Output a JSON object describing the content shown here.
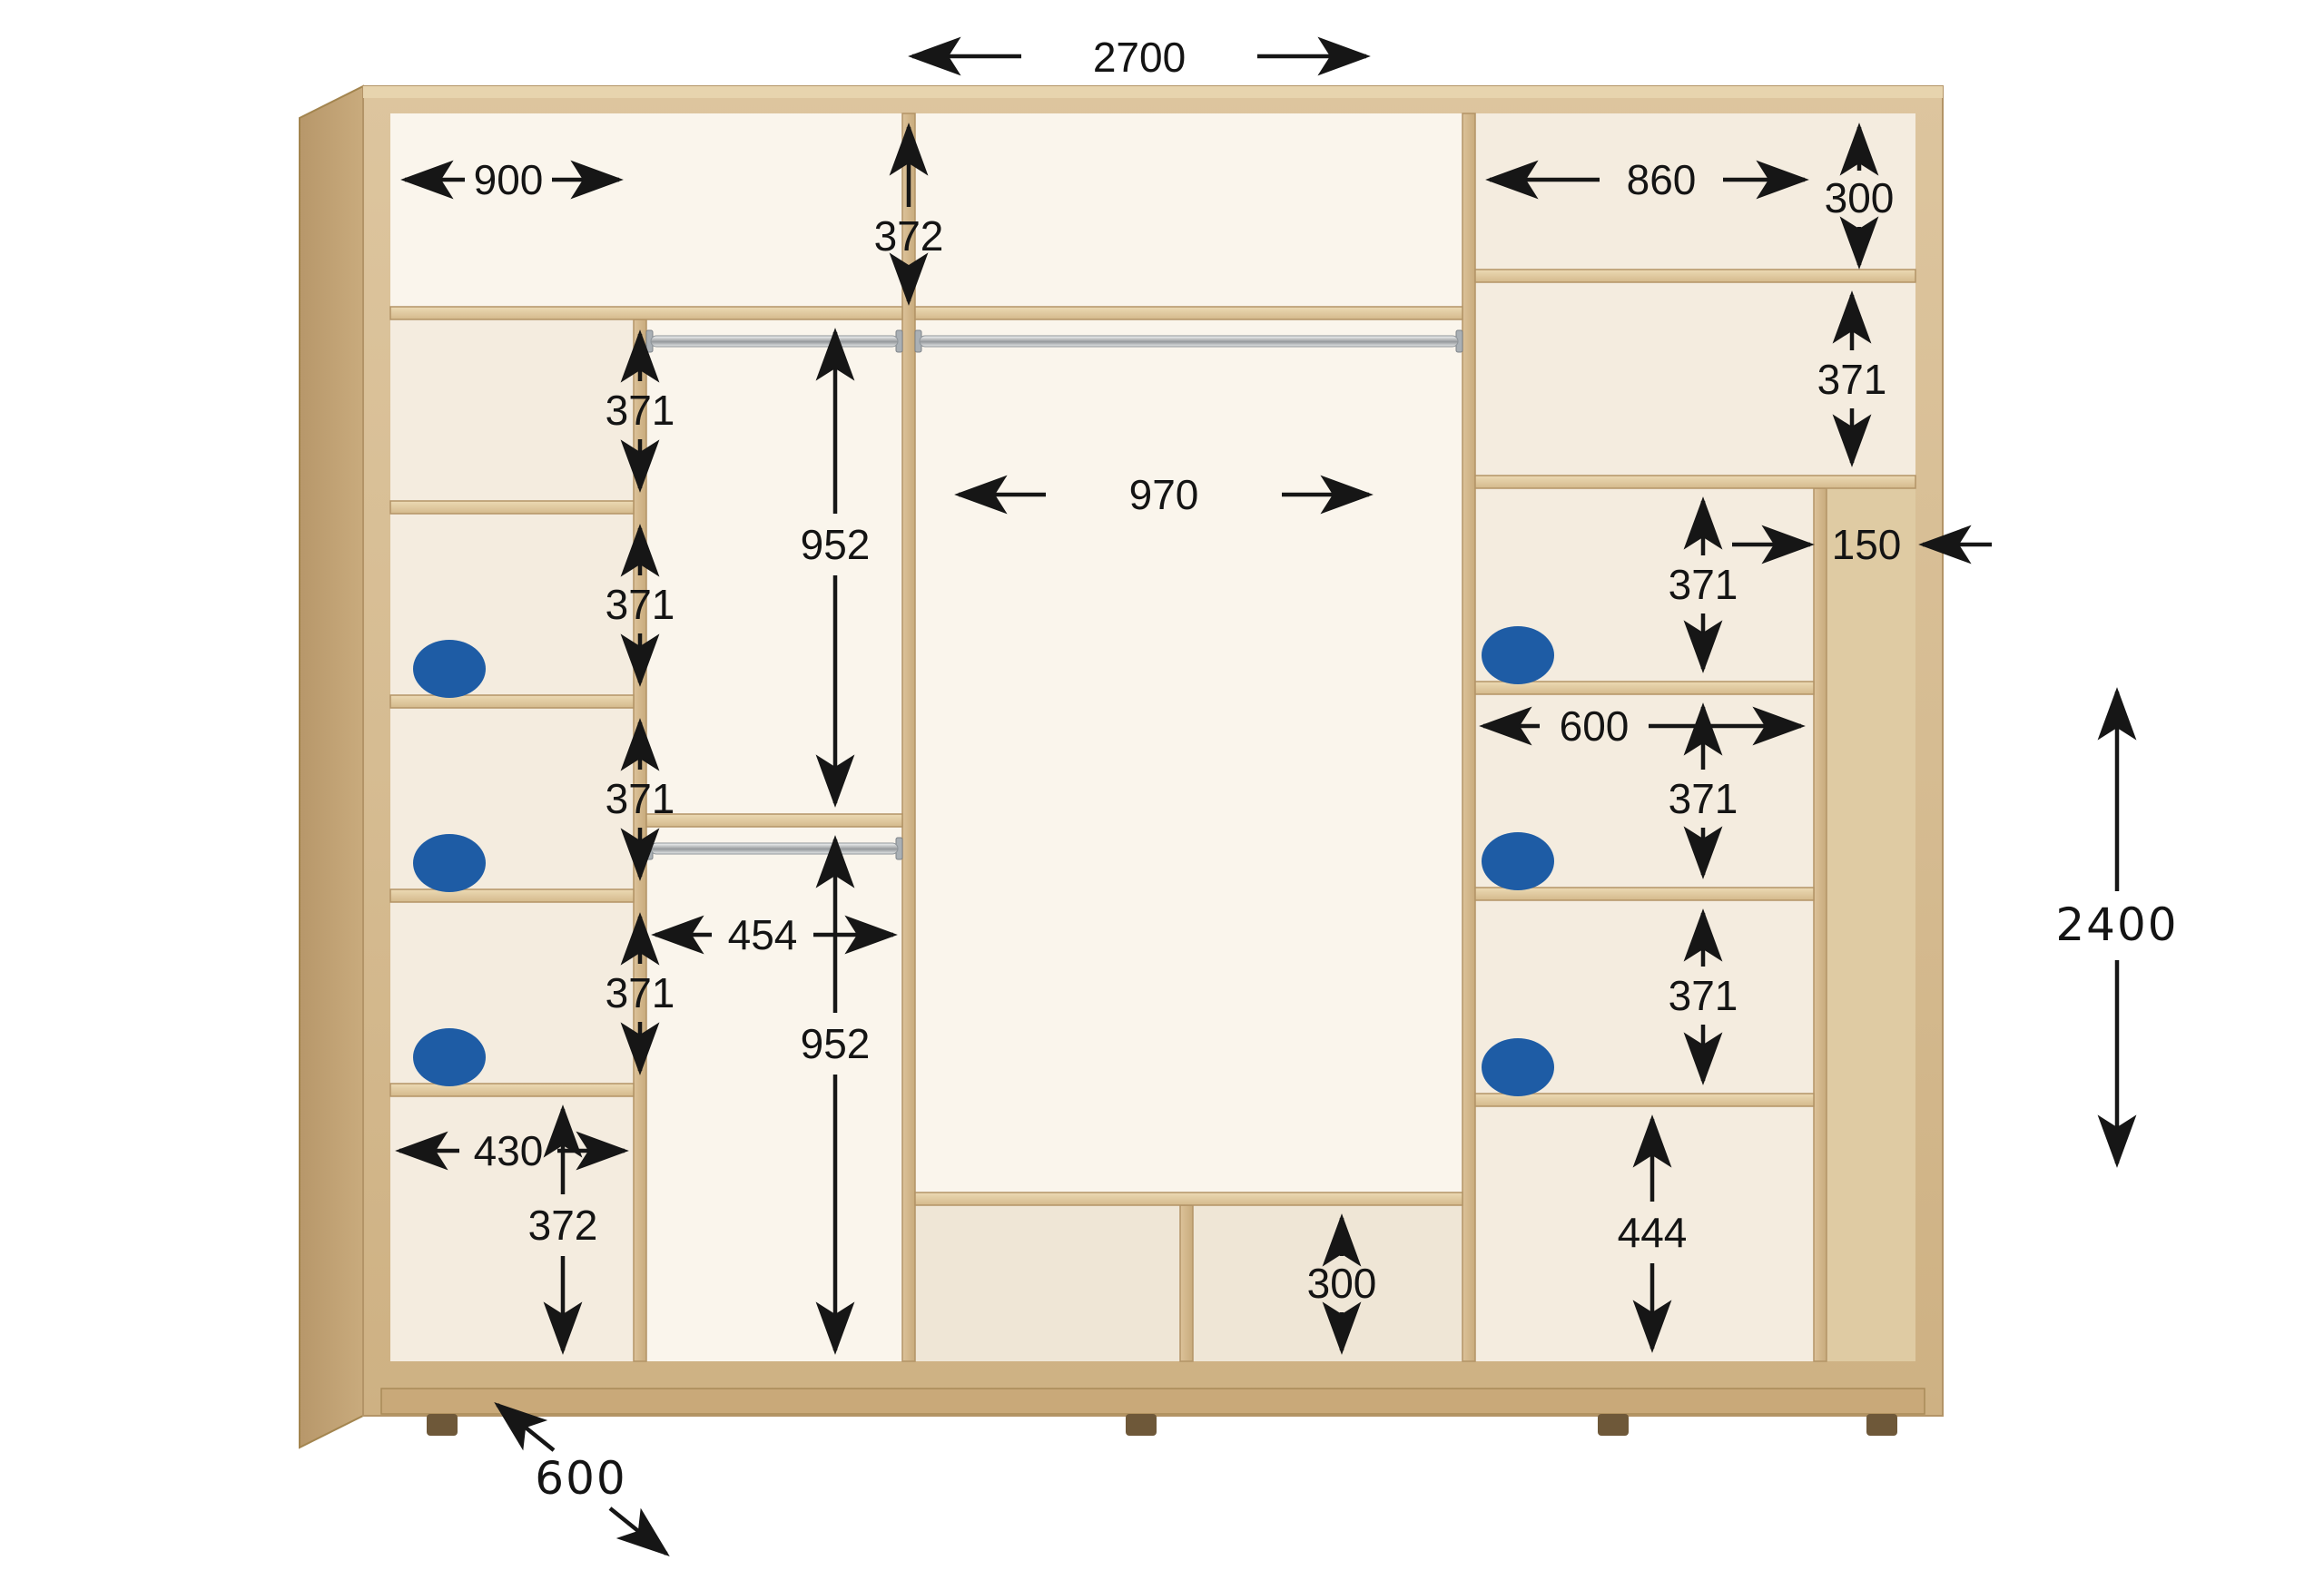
{
  "diagram": {
    "subject": "wardrobe-interior-dimension-diagram",
    "units": "mm",
    "background_color": "#ffffff",
    "wood_color": "#d8bf96",
    "marker_color": "#1e5ca5",
    "dimension_color": "#141414"
  },
  "overall": {
    "width": "2700",
    "height": "2400",
    "depth": "600"
  },
  "top": {
    "left_cell_width": "900",
    "left_cell_height": "372",
    "right_cell_width": "860",
    "right_cell_height": "300"
  },
  "left_col": {
    "cell1_height": "371",
    "cell2_height": "371",
    "cell3_height": "371",
    "cell4_height": "371",
    "bottom_cell_width": "430",
    "bottom_cell_height": "372"
  },
  "hang": {
    "upper_height": "952",
    "width": "454",
    "lower_height": "952"
  },
  "center": {
    "opening_width": "970",
    "bottom_cell_height": "300"
  },
  "right_col": {
    "cell1_height": "371",
    "slot_width": "150",
    "cell2_height": "371",
    "column_width": "600",
    "cell3_height": "371",
    "cell4_height": "371",
    "bottom_cell_height": "444"
  }
}
